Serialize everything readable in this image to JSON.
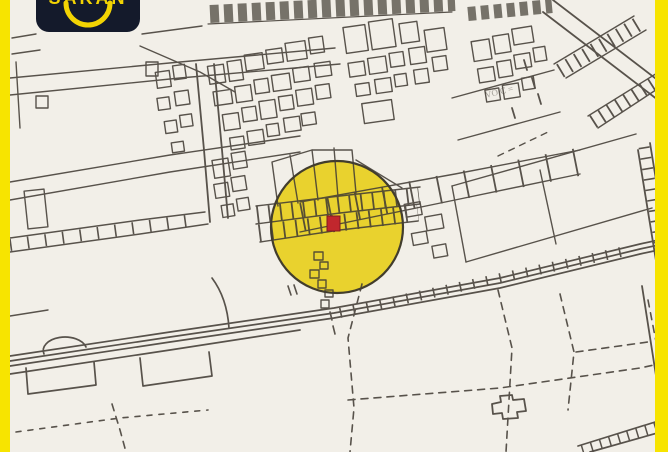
{
  "window": {
    "width": 668,
    "height": 452
  },
  "colors": {
    "frame_yellow": "#f7e400",
    "paper": "#f2efe8",
    "map_line": "#423d35",
    "highlight_circle_fill": "#e9d021",
    "highlight_circle_stroke": "#35301f",
    "marker_red": "#c1272d",
    "marker_red_edge": "#7e1a1f",
    "logo_bg": "#141a2b",
    "logo_accent": "#f3d403"
  },
  "logo": {
    "brand": "SAKAN",
    "icon": "smile-arc"
  },
  "map": {
    "type": "cadastral-line-map",
    "highlight": {
      "shape": "circle",
      "center_x": 337,
      "center_y": 227,
      "radius": 66
    },
    "marker": {
      "shape": "square",
      "x": 327,
      "y": 216,
      "width": 13,
      "height": 15
    },
    "faint_annotation": "VO C ="
  }
}
